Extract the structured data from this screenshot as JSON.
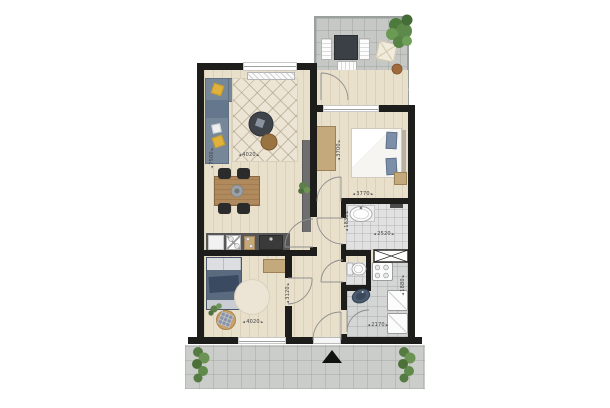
{
  "dimensions": {
    "living": {
      "width": "4020",
      "depth": "7500"
    },
    "bedroom_main": {
      "width": "3770",
      "depth": "3700"
    },
    "bathroom": {
      "width": "2520",
      "depth": "1830"
    },
    "utility": {
      "width": "2170",
      "depth": "1880"
    },
    "bedroom_second": {
      "width": "4020",
      "depth": "3120"
    }
  },
  "colors": {
    "wall": "#1d1d1b",
    "wood_floor": "#e9e0cc",
    "balcony_tile": "#c6c8c6",
    "gallery_tile": "#cbcdcb",
    "bath_tile": "#e0e1e0",
    "sofa": "#76879a",
    "accent_pillow": "#e0b23c",
    "rug": "#ece5d5",
    "coffee_table": "#3f444b",
    "ottoman": "#9a7342",
    "dining_table": "#b08a5c",
    "chair": "#2b2b2b",
    "kitchen_counter": "#575757",
    "cabinet_tan": "#c3a97c",
    "bed_duvet_white": "#f4f3f0",
    "pillow_blue": "#7d8fa8",
    "bed2_duvet": "#5a6b80",
    "plant": "#5d8049",
    "pouf": "#f1ebdb",
    "outdoor_table": "#3b4046",
    "terracotta": "#a06a3a",
    "dim_text": "#3f3f3f"
  }
}
